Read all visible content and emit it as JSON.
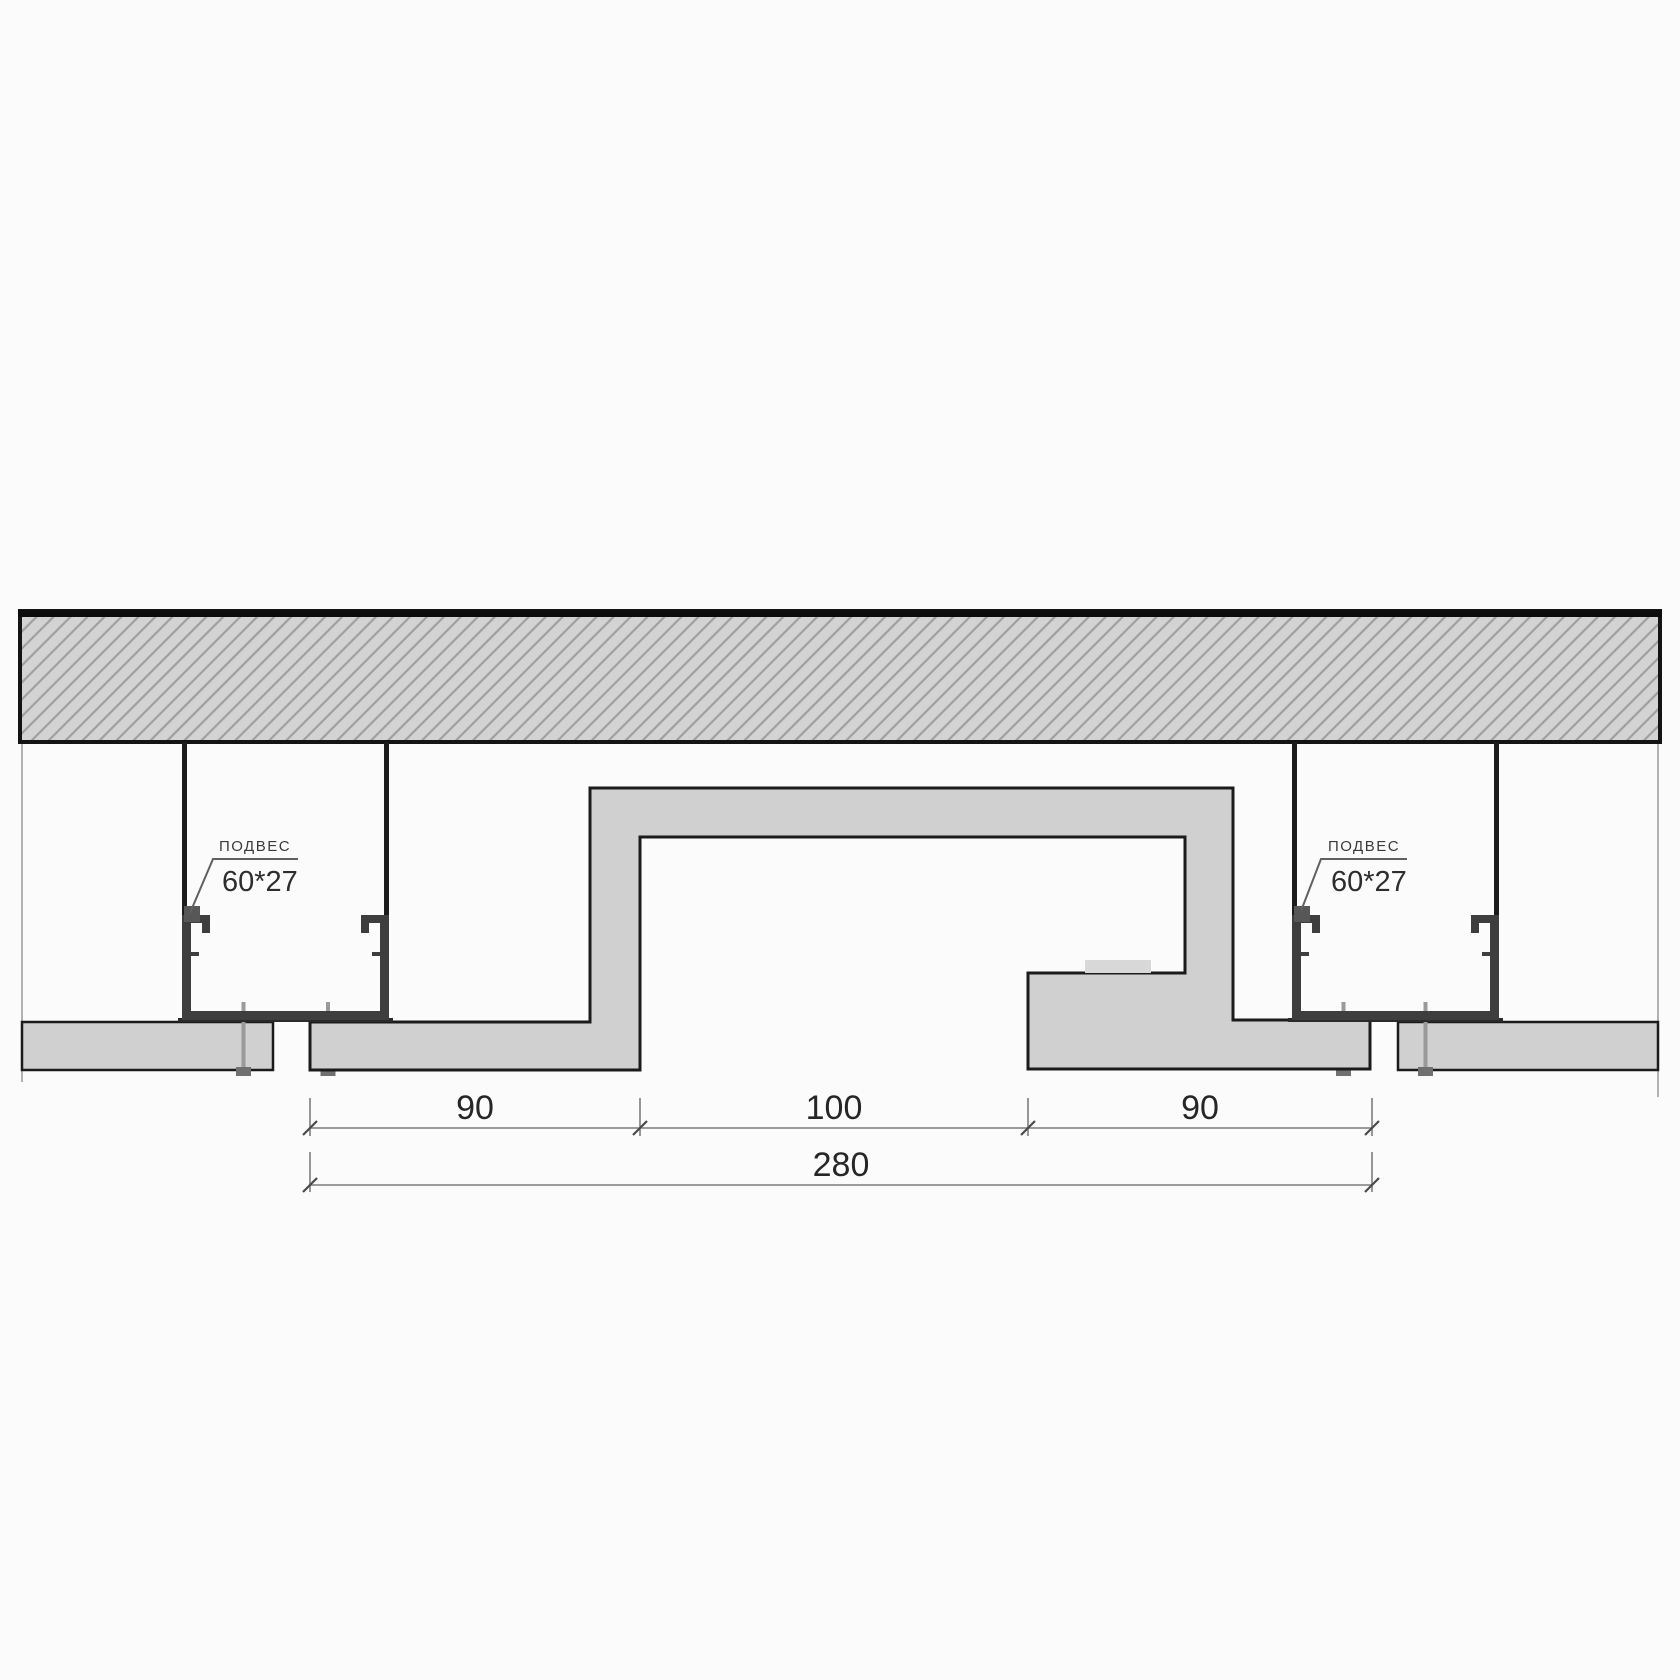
{
  "hangers": {
    "left": {
      "label": "ПОДВЕС",
      "size": "60*27"
    },
    "right": {
      "label": "ПОДВЕС",
      "size": "60*27"
    }
  },
  "dimensions": {
    "segment_left": "90",
    "segment_middle": "100",
    "segment_right": "90",
    "total": "280"
  },
  "colors": {
    "background": "#fbfbfb",
    "slab_fill": "#d3d3d3",
    "hatch_line": "#9f9f9f",
    "outline": "#1b1b1b",
    "board_fill": "#d0d0d0",
    "profile_metal": "#3e3e3e",
    "hanger_clip": "#575757",
    "screw": "#9a9a9a",
    "screw_head": "#707070",
    "dimension_line": "#7d7d7d",
    "dimension_text": "#262626",
    "led_strip": "#d8d8d8"
  }
}
